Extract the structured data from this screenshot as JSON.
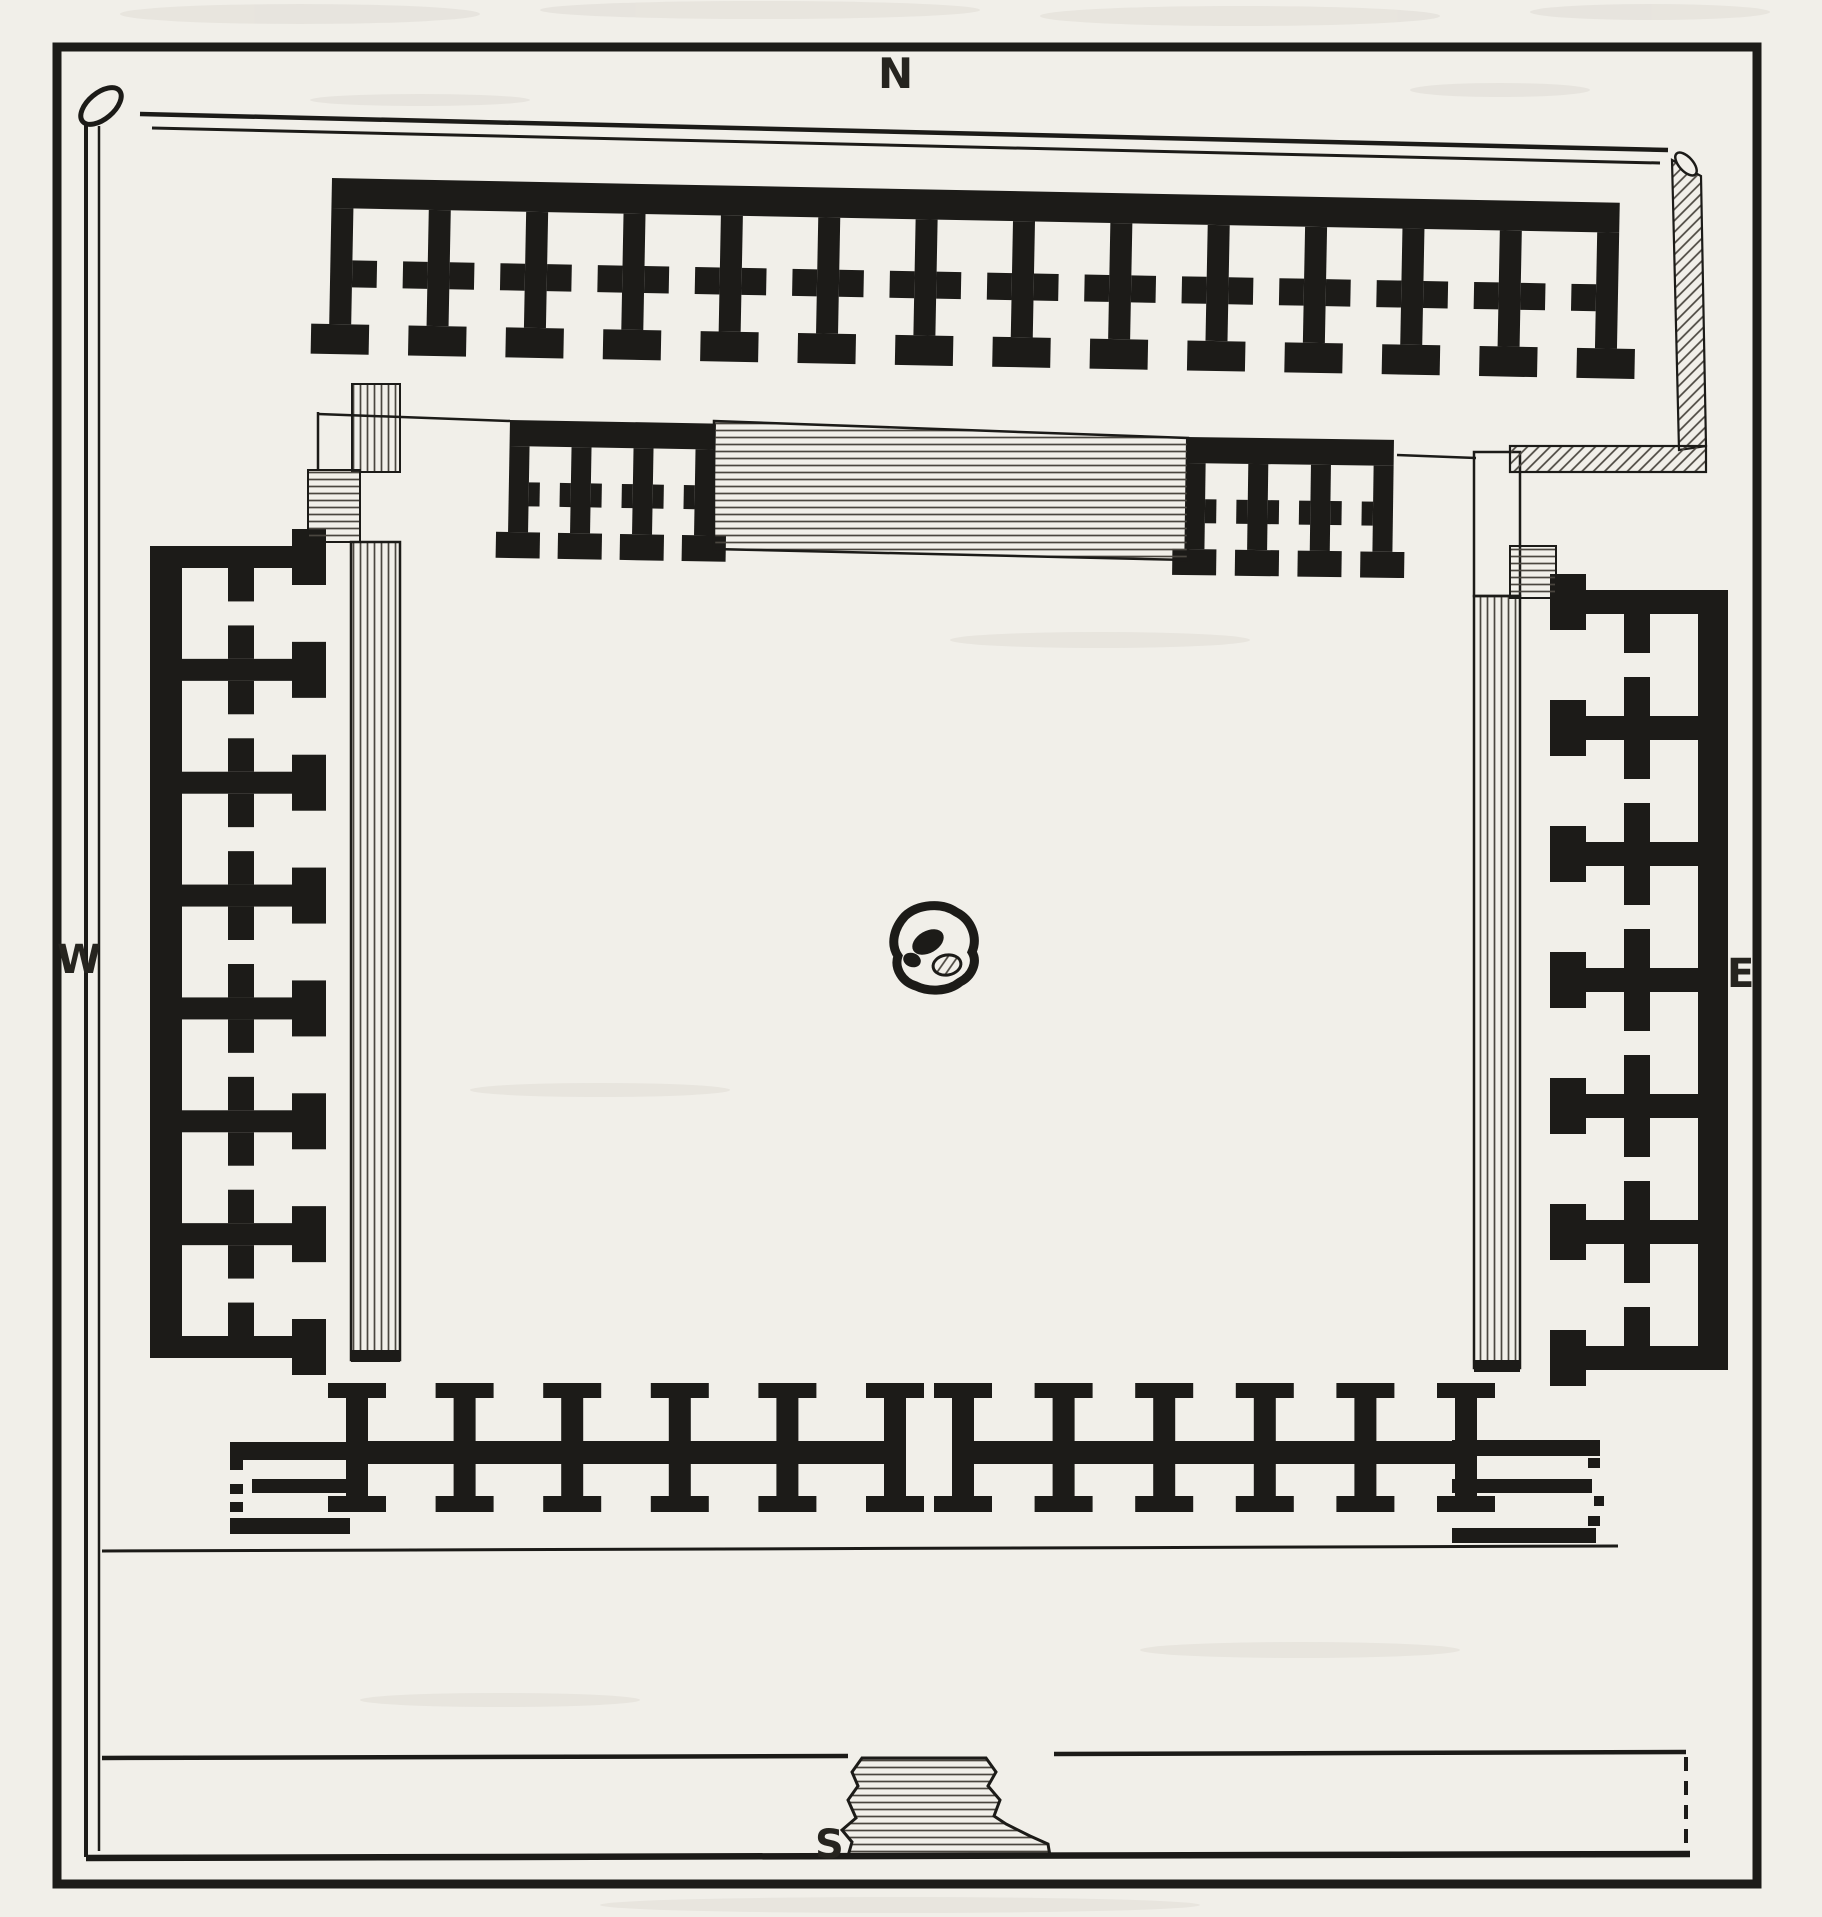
{
  "compass": {
    "north": "N",
    "west": "W",
    "east": "E",
    "south": "S"
  },
  "colors": {
    "paper": "#f1efe9",
    "ink": "#1c1b18",
    "hatch": "#4a463f"
  },
  "plan": {
    "frame": {
      "x": 57,
      "y": 47,
      "w": 1700,
      "h": 1837,
      "stroke": 9
    },
    "ranges": [
      {
        "name": "north-range",
        "orient": "down",
        "x": 332,
        "y": 178,
        "rot": 1.1,
        "length": 1288,
        "cells": 13,
        "back": 30,
        "d1": 82,
        "d2": 109,
        "d3": 146,
        "d4": 176,
        "pw": 22,
        "door": 26,
        "cap": 58
      },
      {
        "name": "north-inner-row-west",
        "orient": "down",
        "x": 510,
        "y": 420,
        "rot": 1.0,
        "length": 206,
        "cells": 3,
        "back": 26,
        "d1": 62,
        "d2": 86,
        "d3": 112,
        "d4": 138,
        "pw": 20,
        "door": 20,
        "cap": 44
      },
      {
        "name": "north-inner-row-east",
        "orient": "down",
        "x": 1186,
        "y": 437,
        "rot": 0.8,
        "length": 208,
        "cells": 3,
        "back": 26,
        "d1": 62,
        "d2": 86,
        "d3": 112,
        "d4": 138,
        "pw": 20,
        "door": 20,
        "cap": 44
      },
      {
        "name": "west-range",
        "orient": "right",
        "x": 150,
        "y": 546,
        "length": 812,
        "cells": 7,
        "back": 32,
        "d1": 78,
        "d2": 104,
        "d3": 142,
        "d4": 176,
        "pw": 22,
        "door": 24,
        "cap": 56
      },
      {
        "name": "east-range",
        "orient": "left",
        "x": 1728,
        "y": 590,
        "length": 780,
        "cells": 6,
        "back": 30,
        "d1": 78,
        "d2": 104,
        "d3": 142,
        "d4": 178,
        "pw": 24,
        "door": 24,
        "cap": 56
      },
      {
        "name": "south-range-west",
        "type": "spine",
        "x": 346,
        "y": 1383,
        "length": 560,
        "cells": 5,
        "pw": 22,
        "cap": 58,
        "capH": 15,
        "stemUp": 43,
        "sw": 23,
        "stemDn": 32,
        "capDnH": 16
      },
      {
        "name": "south-range-east",
        "type": "spine",
        "x": 952,
        "y": 1383,
        "length": 525,
        "cells": 5,
        "pw": 22,
        "cap": 58,
        "capH": 15,
        "stemUp": 43,
        "sw": 23,
        "stemDn": 32,
        "capDnH": 16
      }
    ],
    "hatches": [
      {
        "name": "west-wall-stub",
        "kind": "rect",
        "x": 352,
        "y": 384,
        "w": 48,
        "h": 88,
        "pat": "v",
        "sw": 2
      },
      {
        "name": "west-platform-square",
        "kind": "rect",
        "x": 308,
        "y": 470,
        "w": 52,
        "h": 72,
        "pat": "h",
        "sw": 2
      },
      {
        "name": "west-veranda-strip",
        "kind": "rect",
        "x": 351,
        "y": 542,
        "w": 49,
        "h": 818,
        "pat": "v",
        "sw": 2.5
      },
      {
        "name": "east-veranda-top",
        "kind": "rect",
        "x": 1474,
        "y": 452,
        "w": 46,
        "h": 144,
        "pat": "none",
        "sw": 2.5
      },
      {
        "name": "east-veranda-strip",
        "kind": "rect",
        "x": 1474,
        "y": 596,
        "w": 46,
        "h": 772,
        "pat": "v",
        "sw": 2.5
      },
      {
        "name": "east-platform-square",
        "kind": "rect",
        "x": 1510,
        "y": 546,
        "w": 46,
        "h": 52,
        "pat": "h",
        "sw": 2
      },
      {
        "name": "enclosure-corner-vertical",
        "kind": "poly",
        "pts": "1672,160 1701,176 1706,446 1679,450",
        "pat": "d",
        "sw": 2.2
      },
      {
        "name": "enclosure-corner-horizontal",
        "kind": "rect",
        "x": 1510,
        "y": 446,
        "w": 196,
        "h": 26,
        "pat": "d",
        "sw": 2.2
      },
      {
        "name": "north-inner-hatch-band",
        "kind": "poly",
        "pts": "714,421 1188,438 1188,560 714,549",
        "pat": "h",
        "sw": 2.5
      },
      {
        "name": "south-gateway-pedestal",
        "kind": "path",
        "d": "M862,1758 L986,1758 L996,1772 L988,1786 L1000,1800 L994,1816 L1006,1824 L1030,1836 L1048,1844 L1050,1856 L848,1856 L852,1842 L842,1830 L856,1818 L848,1800 L858,1786 L852,1772 Z",
        "pat": "h",
        "sw": 3
      }
    ],
    "extras": [
      [
        351,
        1350,
        49,
        12
      ],
      [
        1474,
        1360,
        46,
        12
      ],
      [
        230,
        1442,
        120,
        18
      ],
      [
        252,
        1479,
        96,
        14
      ],
      [
        230,
        1518,
        120,
        16
      ],
      [
        230,
        1444,
        13,
        26
      ],
      [
        230,
        1484,
        13,
        10
      ],
      [
        230,
        1502,
        13,
        10
      ],
      [
        230,
        1523,
        13,
        11
      ],
      [
        1452,
        1440,
        148,
        16
      ],
      [
        1452,
        1479,
        140,
        14
      ],
      [
        1452,
        1528,
        144,
        15
      ],
      [
        1588,
        1458,
        12,
        10
      ],
      [
        1594,
        1496,
        10,
        10
      ],
      [
        1588,
        1516,
        12,
        10
      ]
    ],
    "lines": [
      {
        "x1": 140,
        "y1": 114,
        "x2": 1668,
        "y2": 150,
        "w": 4.5
      },
      {
        "x1": 152,
        "y1": 128,
        "x2": 1660,
        "y2": 163,
        "w": 3
      },
      {
        "x1": 86,
        "y1": 112,
        "x2": 86,
        "y2": 1857,
        "w": 4
      },
      {
        "x1": 99,
        "y1": 126,
        "x2": 99,
        "y2": 1851,
        "w": 2.5
      },
      {
        "x1": 86,
        "y1": 1858,
        "x2": 1690,
        "y2": 1854,
        "w": 6.5
      },
      {
        "x1": 318,
        "y1": 412,
        "x2": 318,
        "y2": 470,
        "w": 2.5
      },
      {
        "x1": 318,
        "y1": 414,
        "x2": 510,
        "y2": 421,
        "w": 2.5
      },
      {
        "x1": 1397,
        "y1": 455,
        "x2": 1476,
        "y2": 458,
        "w": 2.5
      },
      {
        "x1": 102,
        "y1": 1551,
        "x2": 1618,
        "y2": 1546,
        "w": 3
      },
      {
        "x1": 102,
        "y1": 1758,
        "x2": 848,
        "y2": 1756,
        "w": 4.5
      },
      {
        "x1": 1054,
        "y1": 1754,
        "x2": 1686,
        "y2": 1752,
        "w": 4.5
      },
      {
        "x1": 1686,
        "y1": 1757,
        "x2": 1686,
        "y2": 1852,
        "w": 4,
        "dash": "14 10"
      }
    ]
  }
}
